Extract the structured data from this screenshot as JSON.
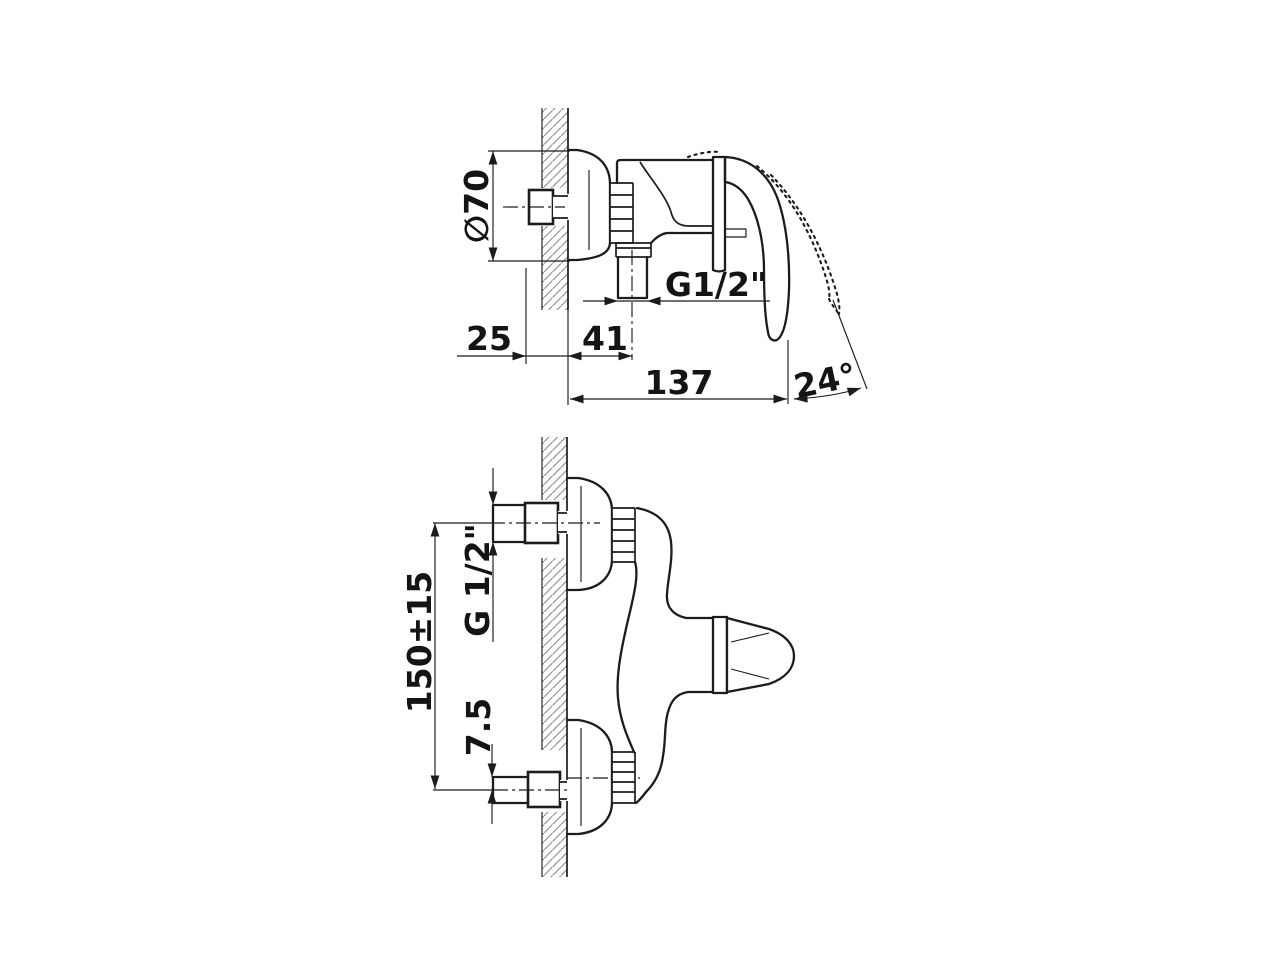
{
  "page": {
    "background": "#ffffff",
    "ink_color": "#1c1c1c",
    "hatch_color": "#8a8a8a",
    "description": "Technical dimension drawing of a wall-mounted single-lever shower mixer: side view above, front view below"
  },
  "side_view": {
    "dim_diameter": "∅70",
    "dim_wall_offset": "25",
    "dim_depth": "41",
    "dim_outlet_thread": "G1/2\"",
    "dim_length": "137",
    "dim_handle_angle": "24°"
  },
  "front_view": {
    "dim_inlet_thread": "G 1/2\"",
    "dim_inlet_spacing": "150±15",
    "dim_eccentric_offset": "7.5"
  }
}
